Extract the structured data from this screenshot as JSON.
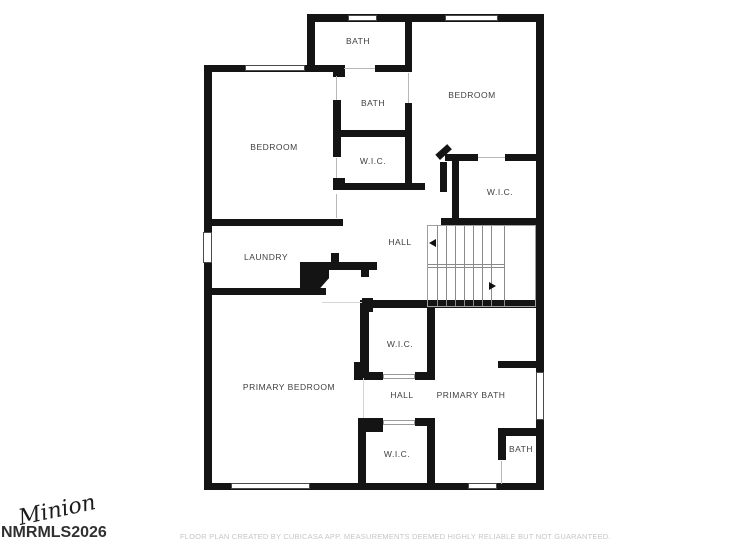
{
  "rooms": [
    {
      "id": "bath-top",
      "label": "BATH"
    },
    {
      "id": "bedroom-right",
      "label": "BEDROOM"
    },
    {
      "id": "bath-middle",
      "label": "BATH"
    },
    {
      "id": "bedroom-left",
      "label": "BEDROOM"
    },
    {
      "id": "wic-middle",
      "label": "W.I.C."
    },
    {
      "id": "wic-right",
      "label": "W.I.C."
    },
    {
      "id": "hall-upper",
      "label": "HALL"
    },
    {
      "id": "laundry",
      "label": "LAUNDRY"
    },
    {
      "id": "wic-suite-upper",
      "label": "W.I.C."
    },
    {
      "id": "primary-bedroom",
      "label": "PRIMARY BEDROOM"
    },
    {
      "id": "hall-suite",
      "label": "HALL"
    },
    {
      "id": "primary-bath",
      "label": "PRIMARY BATH"
    },
    {
      "id": "wic-suite-lower",
      "label": "W.I.C."
    },
    {
      "id": "bath-bottom",
      "label": "BATH"
    }
  ],
  "stairs": {
    "upper_arrow_direction": "left",
    "lower_arrow_direction": "right"
  },
  "watermark": {
    "script_text": "Minion",
    "mls_text": "NMRMLS2026"
  },
  "footer": {
    "disclaimer": "FLOOR PLAN CREATED BY CUBICASA APP. MEASUREMENTS DEEMED HIGHLY RELIABLE BUT NOT GUARANTEED."
  },
  "colors": {
    "background": "#ffffff",
    "wall": "#141414",
    "room_label": "#3f3f3f",
    "disclaimer_text": "#c6c6c6",
    "watermark_text": "#303030"
  }
}
